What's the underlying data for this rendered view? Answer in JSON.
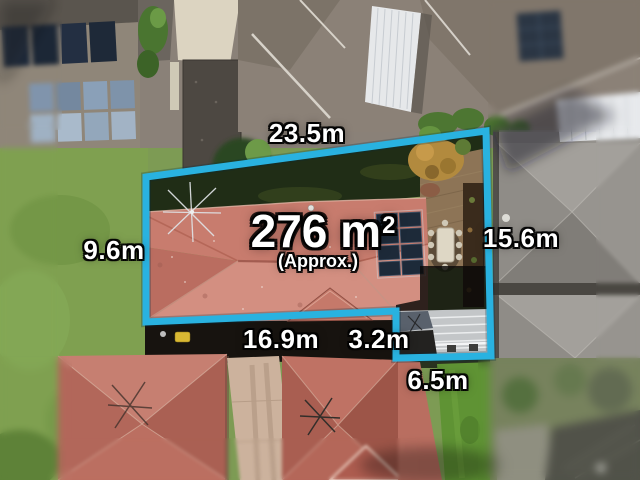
{
  "overlay": {
    "accent_color": "#29b2e0",
    "area": {
      "value": "276 m",
      "superscript": "2",
      "approx": "(Approx.)"
    },
    "measurements": {
      "top": "23.5m",
      "left": "9.6m",
      "right": "15.6m",
      "bottom": "16.9m",
      "step": "3.2m",
      "notch": "6.5m"
    }
  },
  "scene": {
    "colors": {
      "boundary_cyan": "#29b2e0",
      "subject_roof_salmon": "#c87c6e",
      "neighbor_roof_red": "#bd7163",
      "neighbor_roof_grey": "#96938e",
      "lawn_green": "#7fa050",
      "solar_panel_navy": "#1d2a39",
      "garage_roof_grey": "#c3c6c8",
      "label_text": "#ffffff"
    }
  }
}
